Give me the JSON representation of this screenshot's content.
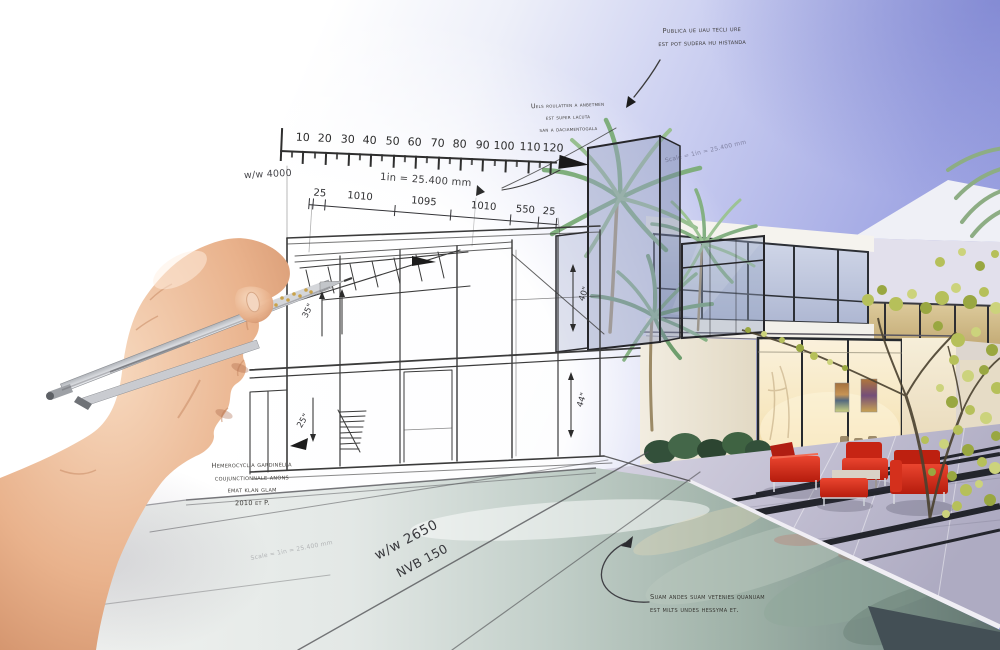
{
  "scene": {
    "title": "Architect's hand sketching a modern villa that blends into a photorealistic render",
    "elements": [
      "hand-with-pen",
      "pencil-sketch-house",
      "imperial-ruler",
      "rendered-villa",
      "palm-trees",
      "red-patio-furniture",
      "swimming-pool",
      "terrace"
    ]
  },
  "ruler": {
    "labels": [
      "10",
      "20",
      "30",
      "40",
      "50",
      "60",
      "70",
      "80",
      "90",
      "100",
      "110",
      "120"
    ],
    "left_label": "w/w 4000",
    "scale_note": "1in = 25.400 mm",
    "segments": [
      "25",
      "1010",
      "1095",
      "1010",
      "550",
      "25"
    ]
  },
  "sketch_dims": {
    "d35": "35\"",
    "d40": "40\"",
    "d44": "44\"",
    "d25": "25\""
  },
  "annotations": {
    "top_right": [
      "Publica ue uau tecli ure",
      "est pot sudera hu histanda"
    ],
    "mid": [
      "Uels roulatten a anbetmen",
      "est super lacuta",
      "san a daciamentogala"
    ],
    "bottom_left": [
      "Hemerocyclia gardinella",
      "coujunctionnale anons",
      "emat klan glam",
      "2010 et P."
    ],
    "bottom_center": [
      "Suam andes suam vetenies quanuam",
      "est milts undes hessyma et."
    ],
    "scale_diagonal": "Scale = 1in = 25.400 mm",
    "pool_mark_1": "w/w 2650",
    "pool_mark_2": "NVB 150"
  },
  "colors": {
    "sky_top_right": "#8b92d8",
    "sky_mid": "#aab0e5",
    "paper": "#ffffff",
    "pencil": "#3a3a3a",
    "palm_green": "#8fb588",
    "tree_yellow_green": "#b6c05a",
    "furniture_red": "#d0271b",
    "terrace": "#c5c2d6",
    "pool_dark": "#49545a",
    "interior_glow": "#f5e3b4"
  }
}
